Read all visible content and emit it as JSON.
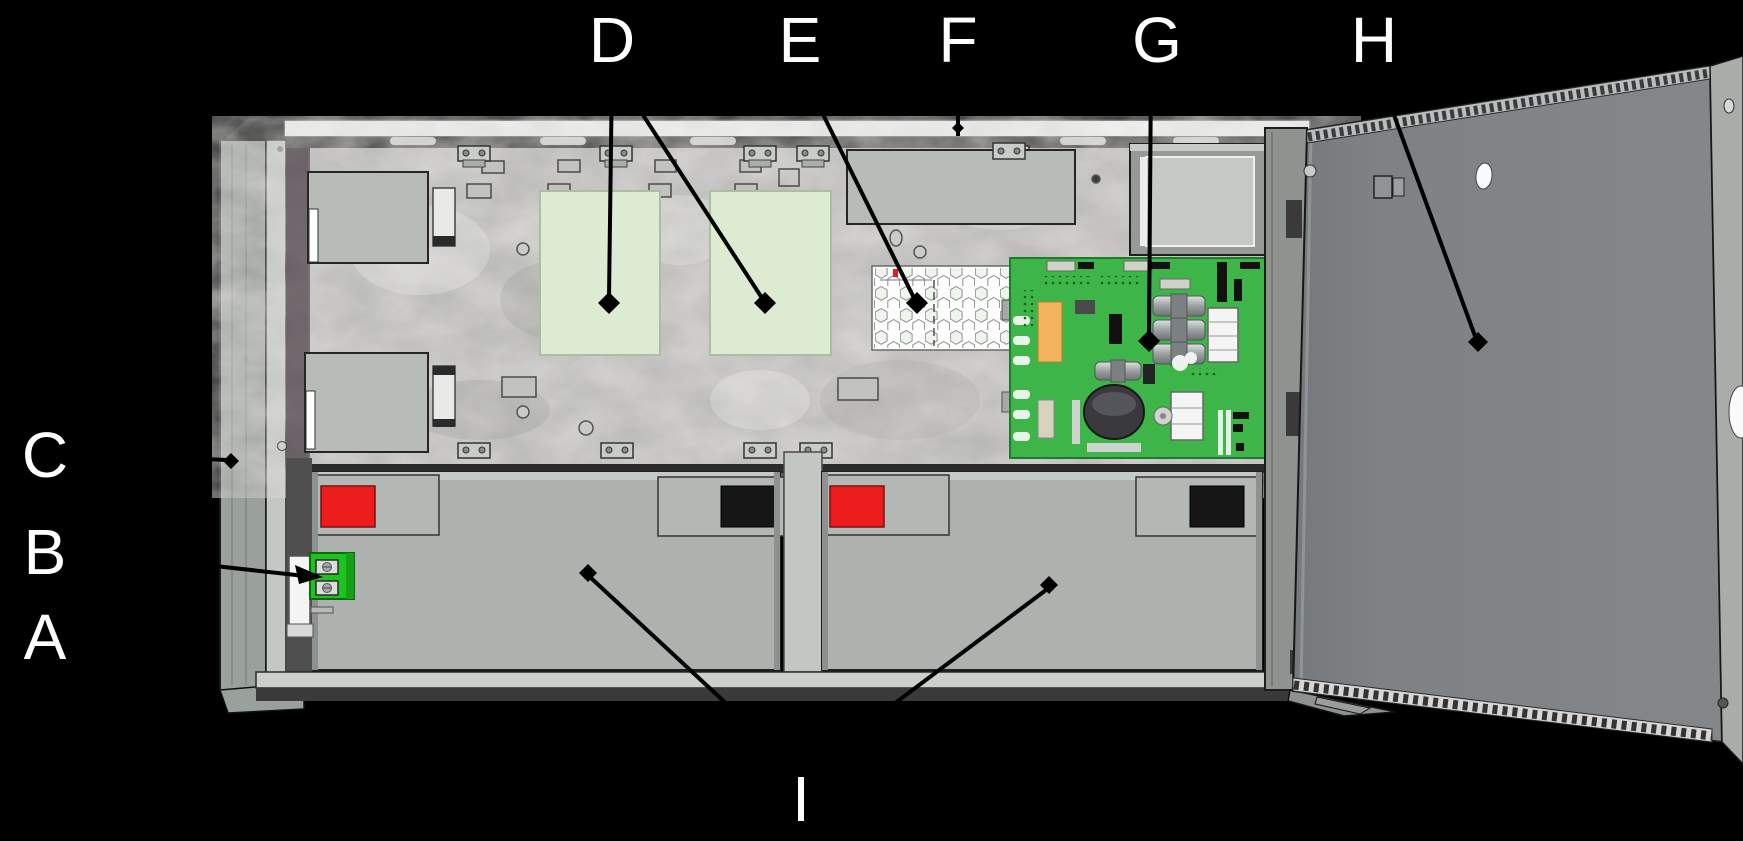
{
  "canvas": {
    "width": 1743,
    "height": 841
  },
  "callouts": {
    "a": {
      "letter": "A",
      "target": "battery-mounting-bracket"
    },
    "b": {
      "letter": "B",
      "target": "battery-terminal-block"
    },
    "c": {
      "letter": "C",
      "target": "backbox-left-flange"
    },
    "d": {
      "letter": "D",
      "target": "option-module-spaces"
    },
    "e": {
      "letter": "E",
      "target": "sounder-grille"
    },
    "f": {
      "letter": "F",
      "target": "backbox-top-rail"
    },
    "g": {
      "letter": "G",
      "target": "main-circuit-board"
    },
    "h": {
      "letter": "H",
      "target": "cabinet-door"
    },
    "i": {
      "letter": "I",
      "target": "standby-batteries"
    }
  },
  "colors": {
    "background": "#000000",
    "label_text": "#ffffff",
    "leader_line": "#000000",
    "cabinet_gray": "#9aa09c",
    "backplate_gray": "#b5b5b3",
    "module_space_green": "#dcebd2",
    "pcb_green": "#3db549",
    "terminal_green": "#1fc31f",
    "battery_gray": "#aeb2af",
    "battery_label_red": "#ee1d1d",
    "battery_label_black": "#161616",
    "honeycomb_white": "#fdfdfd",
    "door_gray": "#7e8284"
  }
}
